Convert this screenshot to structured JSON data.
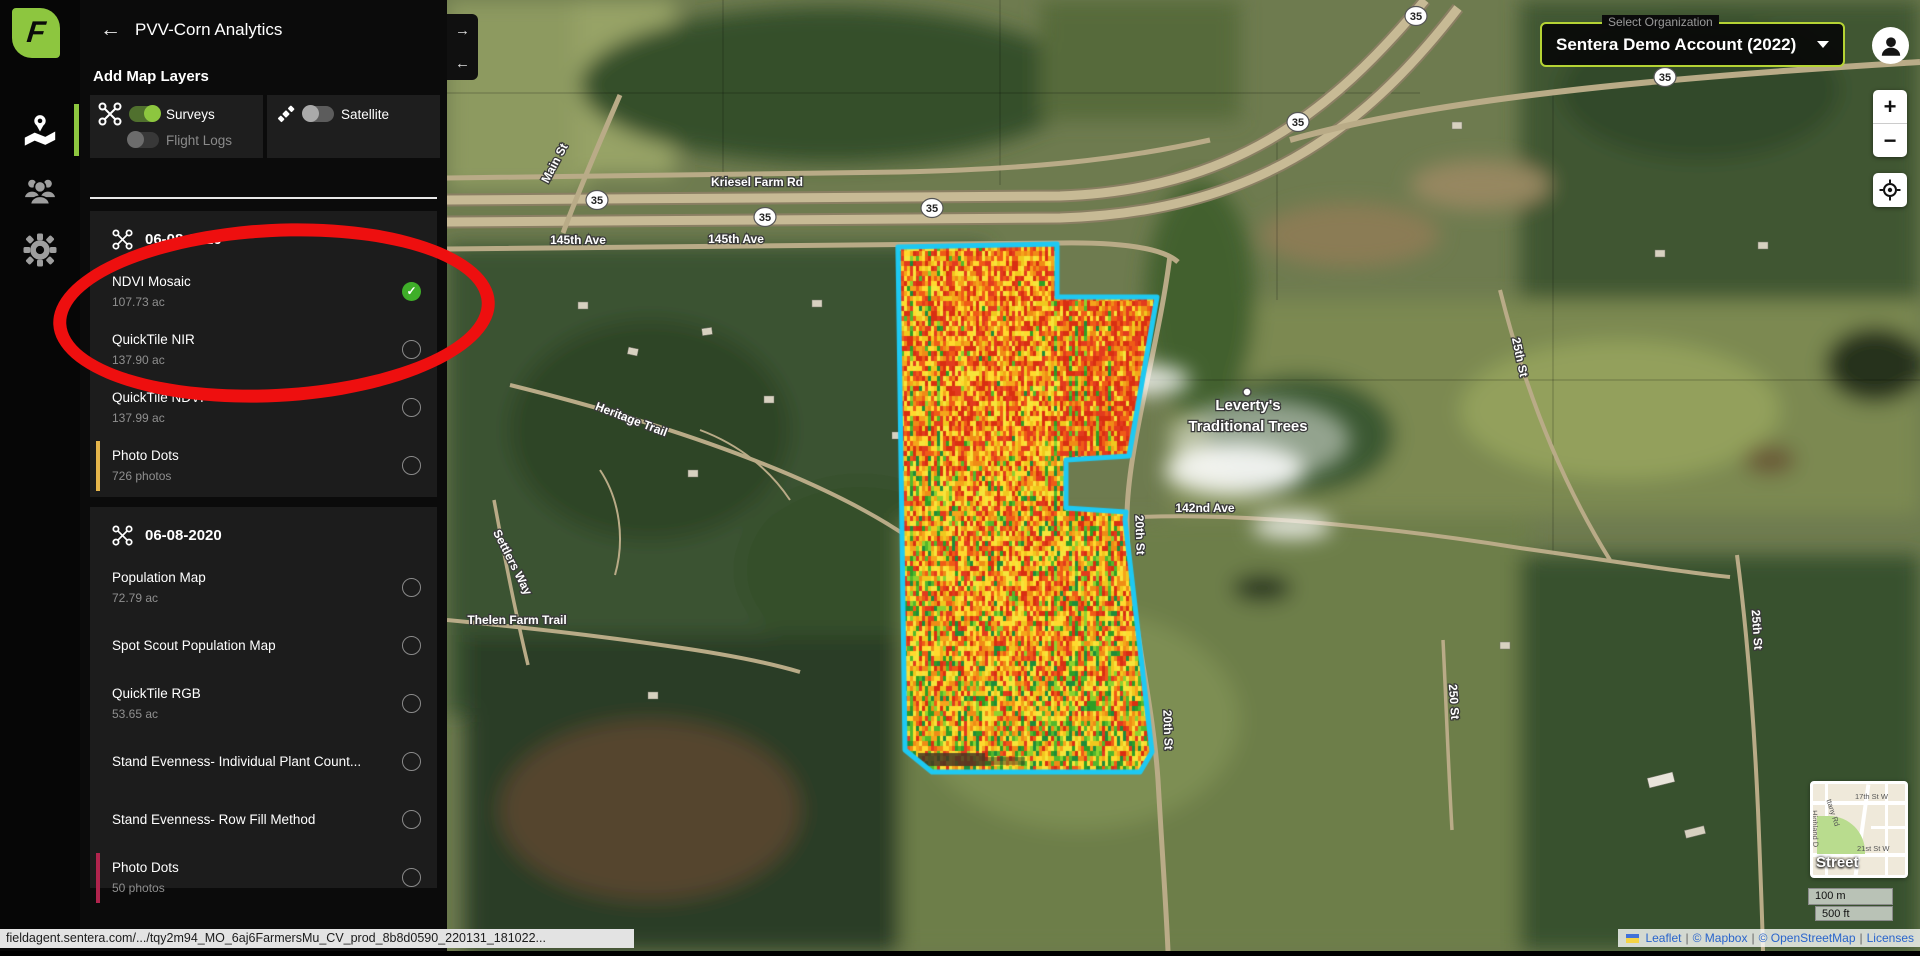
{
  "app": {
    "back_arrow": "←",
    "title": "PVV-Corn Analytics",
    "logo_letter": "F"
  },
  "panel": {
    "add_map_layers": "Add Map Layers",
    "toggles": {
      "surveys": "Surveys",
      "flight_logs": "Flight Logs",
      "satellite": "Satellite"
    },
    "collapse": {
      "right": "→",
      "left": "←"
    },
    "sections": [
      {
        "date": "06-08-2020",
        "items": [
          {
            "label": "NDVI Mosaic",
            "subtitle": "107.73 ac",
            "selected": true,
            "check": "✓"
          },
          {
            "label": "QuickTile NIR",
            "subtitle": "137.90 ac"
          },
          {
            "label": "QuickTile NDVI",
            "subtitle": "137.99 ac"
          },
          {
            "label": "Photo Dots",
            "subtitle": "726 photos"
          }
        ]
      },
      {
        "date": "06-08-2020",
        "items": [
          {
            "label": "Population Map",
            "subtitle": "72.79 ac"
          },
          {
            "label": "Spot Scout Population Map"
          },
          {
            "label": "QuickTile RGB",
            "subtitle": "53.65 ac"
          },
          {
            "label": "Stand Evenness- Individual Plant Count..."
          },
          {
            "label": "Stand Evenness- Row Fill Method"
          },
          {
            "label": "Photo Dots",
            "subtitle": "50 photos"
          }
        ]
      }
    ]
  },
  "header": {
    "org_label": "Select Organization",
    "org_value": "Sentera Demo Account (2022)"
  },
  "map": {
    "zoom_in": "+",
    "zoom_out": "−",
    "shield": "35",
    "labels": {
      "kriesel": "Kriesel Farm Rd",
      "ave145": "145th Ave",
      "main_st": "Main St",
      "heritage": "Heritage Trail",
      "settlers": "Settlers Way",
      "thelen": "Thelen Farm Trail",
      "ave142": "142nd Ave",
      "st20": "20th St",
      "st25": "25th St",
      "st250": "250 St"
    },
    "poi": {
      "line1": "Leverty's",
      "line2": "Traditional Trees"
    },
    "mini": {
      "label": "Street",
      "s17": "17th St W",
      "s21": "21st St W",
      "brittany": "ttany Rd",
      "highland": "Highland D"
    },
    "scale": {
      "metric": "100 m",
      "imperial": "500 ft"
    },
    "attribution": {
      "leaflet": "Leaflet",
      "mapbox": "© Mapbox",
      "osm": "© OpenStreetMap",
      "licenses": "Licenses",
      "sep": "|"
    }
  },
  "status_bar": {
    "url": "fieldagent.sentera.com/.../tqy2m94_MO_6aj6FarmersMu_CV_prod_8b8d0590_220131_181022..."
  },
  "colors": {
    "brand_green": "#8dc63f",
    "toggle_on": "#8dc63f",
    "check_green": "#3fae29",
    "field_outline": "#1ec9f2",
    "annotation_red": "#ee0f0f",
    "org_border": "#b5d334",
    "accent_amber": "#e5b54b",
    "accent_crimson": "#b0244d"
  },
  "ndvi_palette": {
    "reds": [
      "#e23b1e",
      "#ef5b17",
      "#d92f12"
    ],
    "oranges": [
      "#f5a51b",
      "#f0c81e",
      "#ef8c16"
    ],
    "yellows": [
      "#f6e43a",
      "#ffd92e"
    ],
    "greens": [
      "#53b82c",
      "#2f9e25",
      "#8ed12e",
      "#1f8c3a"
    ]
  }
}
